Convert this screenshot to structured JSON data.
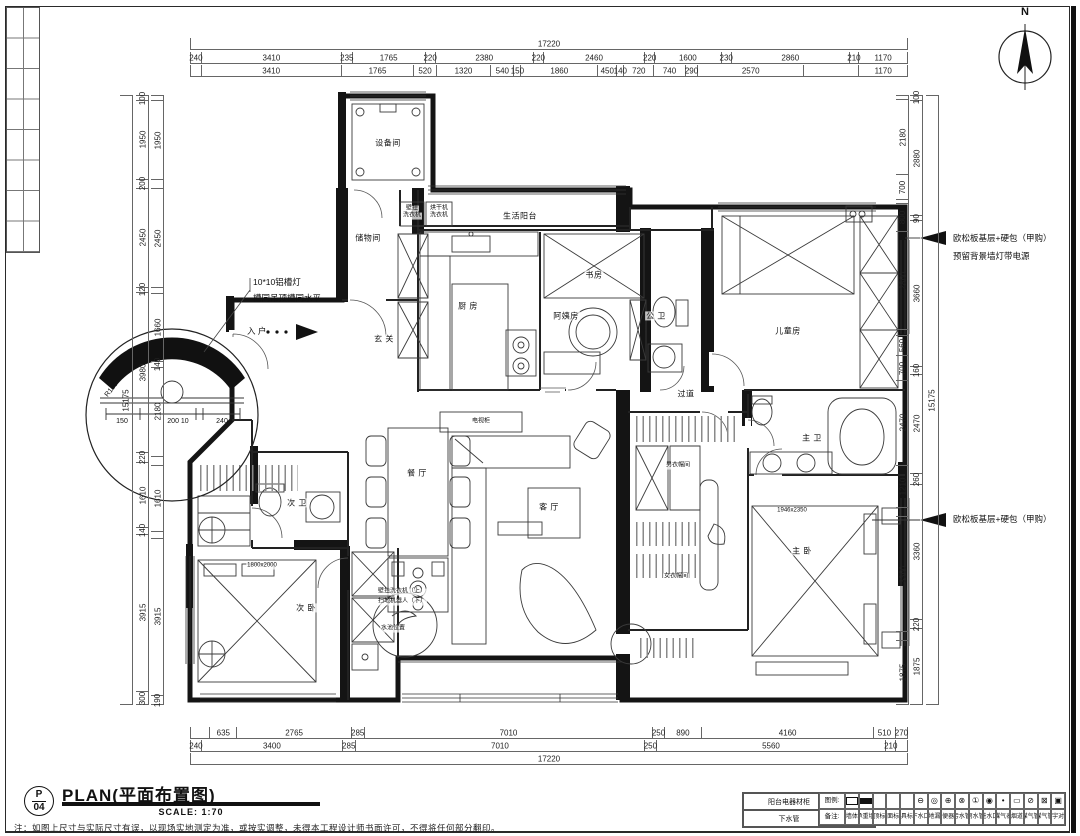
{
  "title": {
    "code_top": "P",
    "code_bottom": "04",
    "main": "PLAN(平面布置图)",
    "scale": "SCALE: 1:70",
    "note": "注：如图上尺寸与实际尺寸有误，以现场实地测定为准，或按实调整，未得本工程设计师书面许可，不得将任何部分翻印。"
  },
  "north": {
    "label": "N"
  },
  "dims": {
    "top_total": [
      "17220"
    ],
    "top1": [
      "240",
      "3410",
      "235",
      "1765",
      "220",
      "2380",
      "220",
      "2460",
      "220",
      "1600",
      "230",
      "2860",
      "210",
      "1170"
    ],
    "top2": [
      "~240",
      "3410",
      "1765",
      "520",
      "1320",
      "540",
      "150",
      "1860",
      "450",
      "140",
      "720",
      "740",
      "290",
      "2570",
      "~1335",
      "1170"
    ],
    "bottom1": [
      "~445",
      "635",
      "2765",
      "285",
      "7010",
      "250",
      "890",
      "4160",
      "510",
      "270"
    ],
    "bottom2": [
      "240",
      "3400",
      "285",
      "7010",
      "250",
      "5560",
      "210",
      "~265"
    ],
    "bottom_total": [
      "17220"
    ],
    "left_total": [
      "15175"
    ],
    "left_outer": [
      "100",
      "1950",
      "200",
      "2450",
      "120",
      "3980",
      "220",
      "1610",
      "140",
      "3915",
      "300"
    ],
    "left_inner": [
      "~100",
      "1950",
      "~200",
      "2450",
      "~120",
      "1660",
      "140",
      "2180",
      "~220",
      "1610",
      "~140",
      "3915",
      "190"
    ],
    "right_inner": [
      "~100",
      "2180",
      "700",
      "~90",
      "800",
      "2860",
      "~160",
      "560",
      "700",
      "2470",
      "1210",
      "~260",
      "3360",
      "~220",
      "1875"
    ],
    "right_outer": [
      "100",
      "2880",
      "90",
      "3660",
      "160",
      "2470",
      "260",
      "3360",
      "220",
      "1875"
    ],
    "right_total": [
      "15175"
    ]
  },
  "rooms": [
    {
      "t": "设备间",
      "x": 388,
      "y": 143
    },
    {
      "t": "储物间",
      "x": 368,
      "y": 238
    },
    {
      "t": "生活阳台",
      "x": 520,
      "y": 216
    },
    {
      "t": "厨 房",
      "x": 468,
      "y": 306
    },
    {
      "t": "玄 关",
      "x": 384,
      "y": 339
    },
    {
      "t": "书房",
      "x": 594,
      "y": 275
    },
    {
      "t": "阿姨房",
      "x": 566,
      "y": 316
    },
    {
      "t": "公 卫",
      "x": 656,
      "y": 316
    },
    {
      "t": "儿童房",
      "x": 788,
      "y": 331
    },
    {
      "t": "过道",
      "x": 686,
      "y": 394
    },
    {
      "t": "主 卫",
      "x": 812,
      "y": 438
    },
    {
      "t": "男衣帽间",
      "x": 678,
      "y": 466,
      "cls": "t6"
    },
    {
      "t": "女衣帽间",
      "x": 676,
      "y": 577,
      "cls": "t6"
    },
    {
      "t": "主 卧",
      "x": 802,
      "y": 551
    },
    {
      "t": "餐 厅",
      "x": 417,
      "y": 473
    },
    {
      "t": "客 厅",
      "x": 549,
      "y": 507
    },
    {
      "t": "电视柜",
      "x": 481,
      "y": 422,
      "cls": "t6"
    },
    {
      "t": "次 卫",
      "x": 297,
      "y": 503
    },
    {
      "t": "次 卧",
      "x": 306,
      "y": 608
    }
  ],
  "notes": [
    {
      "t": "10*10铝槽灯",
      "x": 252,
      "y": 283,
      "cls": "t8 l"
    },
    {
      "t": "槽同吊顶槽同水平",
      "x": 252,
      "y": 299,
      "cls": "t8 l"
    },
    {
      "t": "入 户",
      "x": 246,
      "y": 332,
      "cls": "t8 l"
    },
    {
      "t": "欧松板基层+硬包（甲购）",
      "x": 952,
      "y": 239,
      "cls": "t8 l"
    },
    {
      "t": "预留背景墙灯带电源",
      "x": 952,
      "y": 257,
      "cls": "t8 l"
    },
    {
      "t": "欧松板基层+硬包（甲购）",
      "x": 952,
      "y": 520,
      "cls": "t8 l"
    },
    {
      "t": "150",
      "x": 122,
      "y": 422,
      "cls": "t7"
    },
    {
      "t": "200 10",
      "x": 178,
      "y": 422,
      "cls": "t7"
    },
    {
      "t": "240",
      "x": 222,
      "y": 422,
      "cls": "t7"
    },
    {
      "t": "R150",
      "x": 112,
      "y": 390,
      "cls": "t7 rot50"
    },
    {
      "t": "壁挂",
      "x": 412,
      "y": 209,
      "cls": "t6"
    },
    {
      "t": "洗衣机",
      "x": 412,
      "y": 216,
      "cls": "t6"
    },
    {
      "t": "烘干机",
      "x": 439,
      "y": 209,
      "cls": "t6"
    },
    {
      "t": "洗衣机",
      "x": 439,
      "y": 216,
      "cls": "t6"
    },
    {
      "t": "壁挂洗衣机（上）",
      "x": 377,
      "y": 592,
      "cls": "t6 l"
    },
    {
      "t": "扫地机器人（下）",
      "x": 377,
      "y": 602,
      "cls": "t6 l"
    },
    {
      "t": "水池位置",
      "x": 380,
      "y": 629,
      "cls": "t6 l"
    },
    {
      "t": "1800x2000",
      "x": 262,
      "y": 566,
      "cls": "t6"
    },
    {
      "t": "1946x2350",
      "x": 792,
      "y": 511,
      "cls": "t6"
    }
  ],
  "utility_table": {
    "cells": [
      "阳台电器材柜",
      "电/箱",
      "下水管",
      "PVC管"
    ]
  },
  "legend": {
    "row1_header": "图例:",
    "row2_header": "备注:",
    "items": [
      {
        "sym": "RO",
        "label": "墙体"
      },
      {
        "sym": "RF",
        "label": "承重墙"
      },
      {
        "sym": "",
        "label": "吊顶标高"
      },
      {
        "sym": "",
        "label": "地面标高"
      },
      {
        "sym": "",
        "label": "家具标高"
      },
      {
        "sym": "⊖",
        "label": "下水口"
      },
      {
        "sym": "◎",
        "label": "地漏"
      },
      {
        "sym": "⊕",
        "label": "座便器位"
      },
      {
        "sym": "⊗",
        "label": "污水管"
      },
      {
        "sym": "①",
        "label": "雨水管"
      },
      {
        "sym": "◉",
        "label": "进水口"
      },
      {
        "sym": "•",
        "label": "煤气表"
      },
      {
        "sym": "▭",
        "label": "烟道"
      },
      {
        "sym": "⊘",
        "label": "煤气管"
      },
      {
        "sym": "⊠",
        "label": "煤气管"
      },
      {
        "sym": "▣",
        "label": "楼宇对讲"
      }
    ]
  }
}
